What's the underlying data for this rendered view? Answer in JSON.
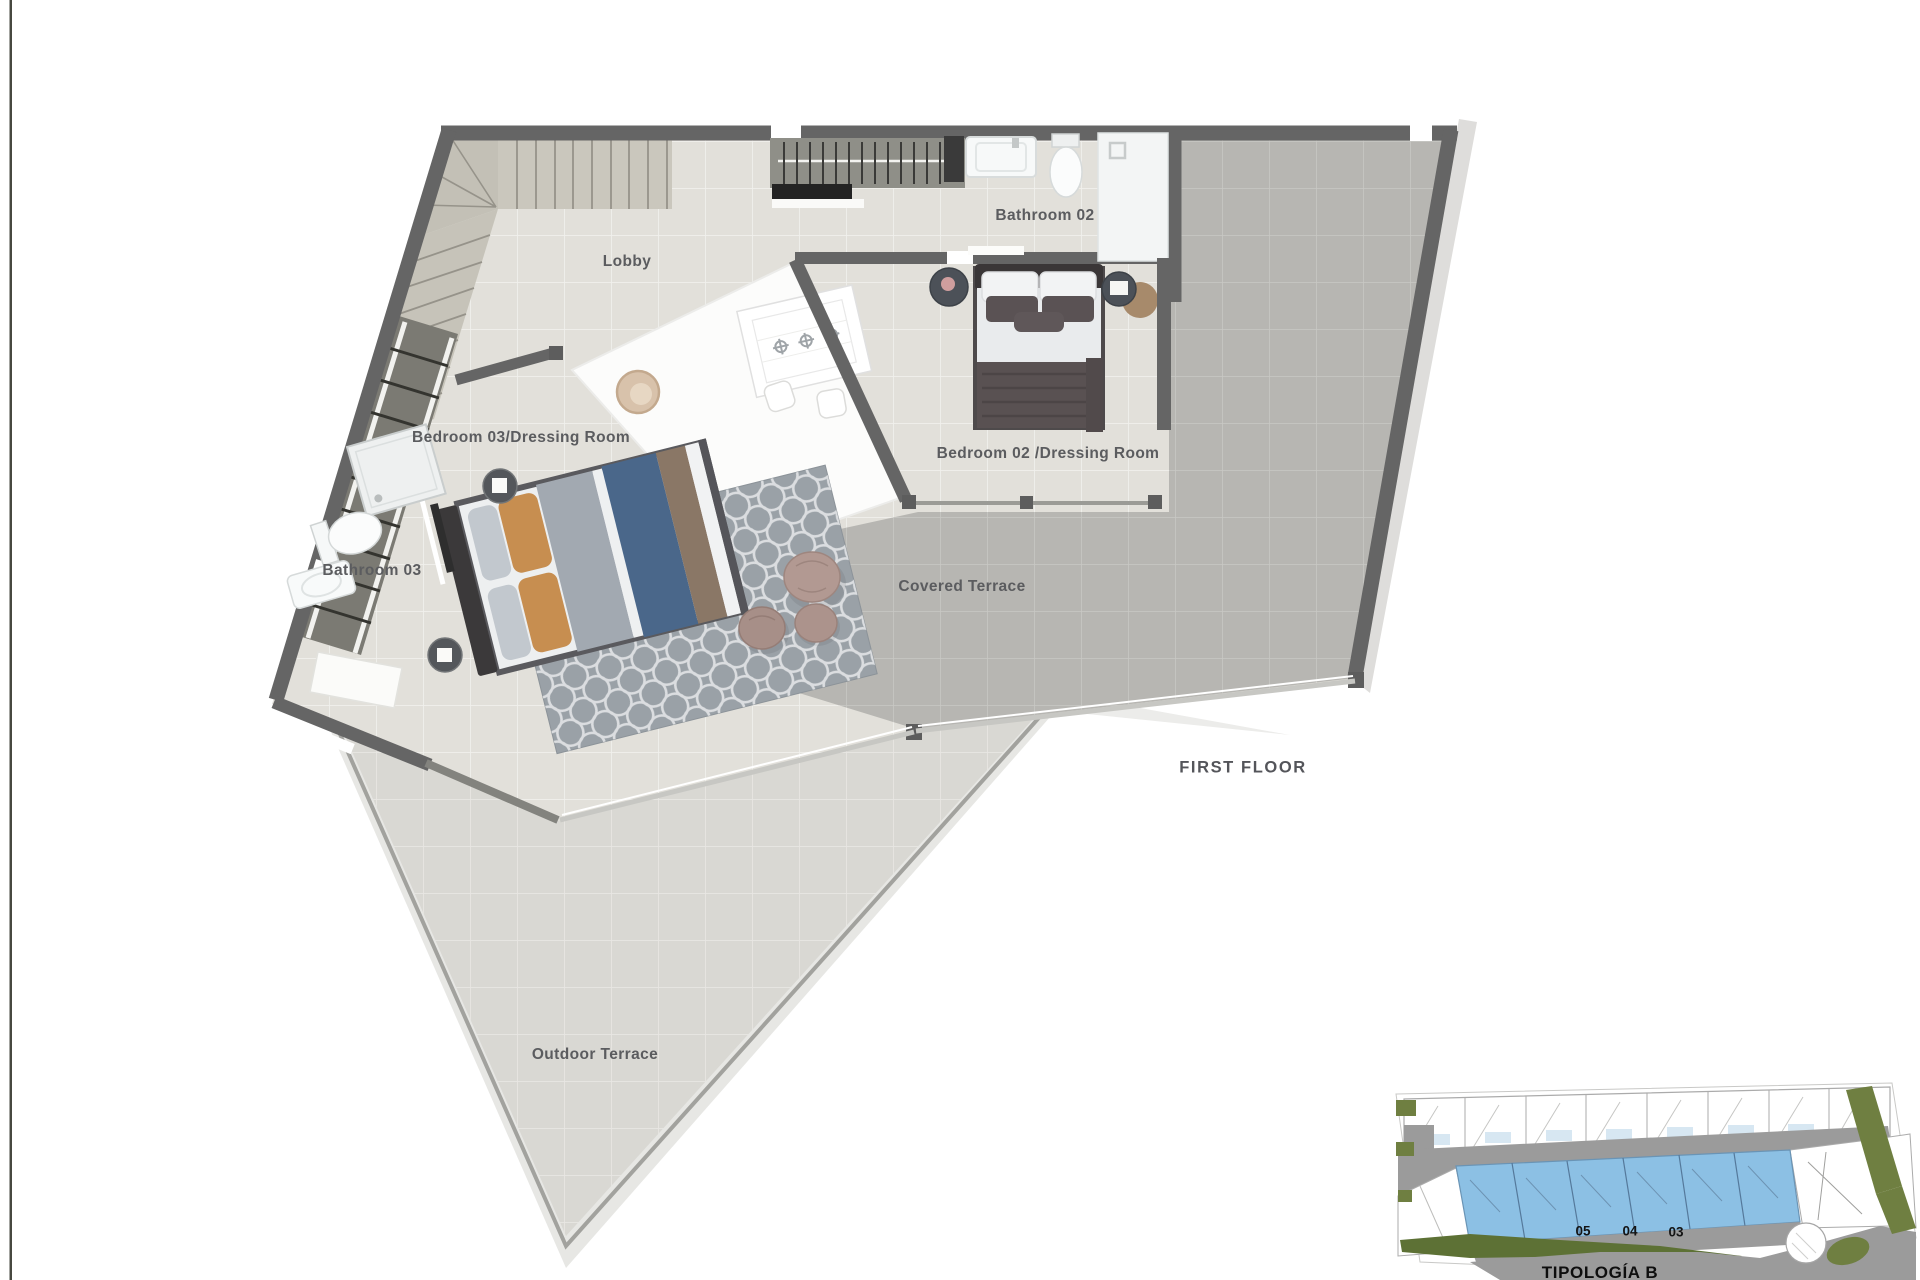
{
  "document": {
    "type": "architectural-floor-plan",
    "floor_title": "FIRST FLOOR",
    "rooms": [
      {
        "id": "lobby",
        "label": "Lobby"
      },
      {
        "id": "bathroom-02",
        "label": "Bathroom 02"
      },
      {
        "id": "bedroom-03-dressing",
        "label": "Bedroom 03/Dressing Room"
      },
      {
        "id": "bedroom-02-dressing",
        "label": "Bedroom 02 /Dressing Room"
      },
      {
        "id": "bathroom-03",
        "label": "Bathroom 03"
      },
      {
        "id": "covered-terrace",
        "label": "Covered Terrace"
      },
      {
        "id": "outdoor-terrace",
        "label": "Outdoor Terrace"
      }
    ]
  },
  "site_inset": {
    "typology_label": "TIPOLOGÍA B",
    "unit_numbers": [
      "05",
      "04",
      "03"
    ],
    "highlight_color": "#8cc0e4"
  },
  "colors": {
    "wall": "#656565",
    "interior_floor": "#e2e0da",
    "covered_terrace_floor": "#b7b6b2",
    "outdoor_terrace_floor": "#d9d8d3",
    "label_text": "#5b5c5f",
    "site_road": "#9b9b9b",
    "site_green": "#5d7135"
  }
}
